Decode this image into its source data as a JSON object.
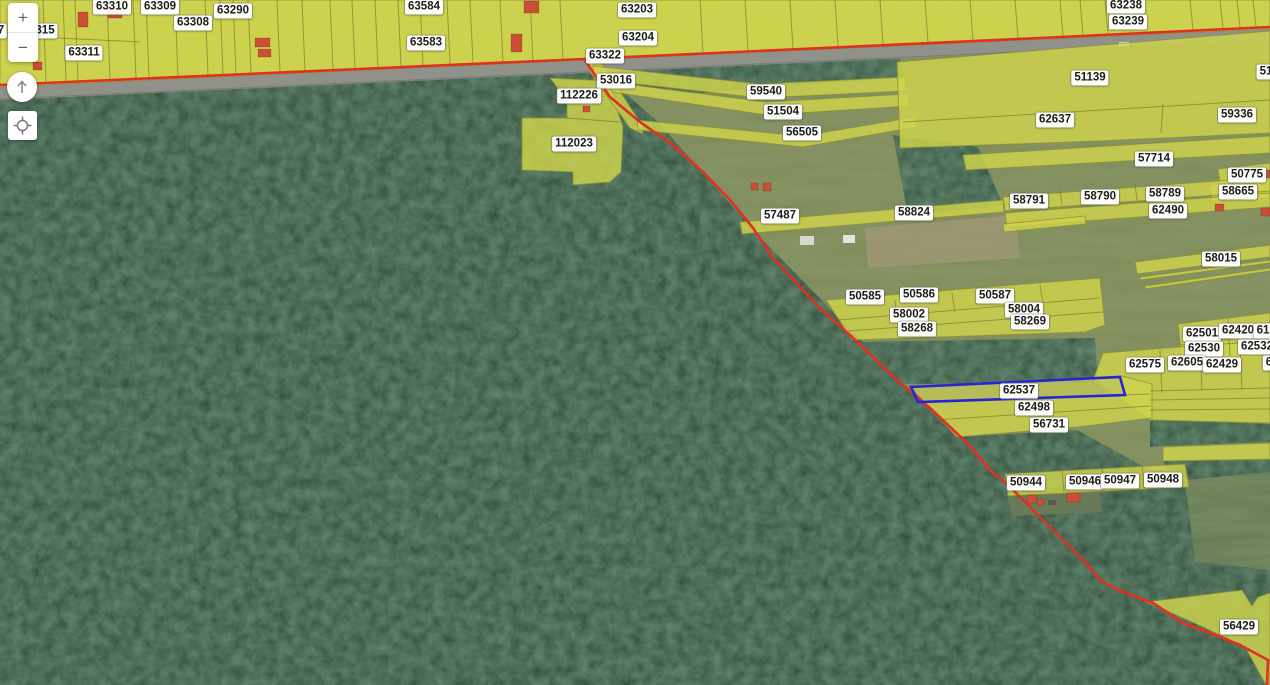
{
  "app": {
    "description": "cadastral parcel map viewer over aerial imagery"
  },
  "controls": {
    "zoom_in": "+",
    "zoom_out": "−"
  },
  "map": {
    "selected_parcel_id": "62537",
    "colors": {
      "parcel_highlight": "#d0d44c",
      "boundary_line": "#e03022",
      "selection_outline": "#2525d6",
      "label_background": "#ffffff",
      "road": "#90918b"
    },
    "labels": [
      {
        "id": "7",
        "x": 1,
        "y": 31
      },
      {
        "id": "315",
        "x": 45,
        "y": 31
      },
      {
        "id": "63311",
        "x": 84,
        "y": 53
      },
      {
        "id": "63310",
        "x": 112,
        "y": 7
      },
      {
        "id": "63309",
        "x": 160,
        "y": 7
      },
      {
        "id": "63308",
        "x": 193,
        "y": 23
      },
      {
        "id": "63290",
        "x": 233,
        "y": 11
      },
      {
        "id": "63584",
        "x": 424,
        "y": 7
      },
      {
        "id": "63583",
        "x": 426,
        "y": 43
      },
      {
        "id": "63203",
        "x": 637,
        "y": 10
      },
      {
        "id": "63204",
        "x": 638,
        "y": 38
      },
      {
        "id": "63322",
        "x": 605,
        "y": 56
      },
      {
        "id": "63238",
        "x": 1126,
        "y": 6
      },
      {
        "id": "63239",
        "x": 1128,
        "y": 22
      },
      {
        "id": "53016",
        "x": 616,
        "y": 81
      },
      {
        "id": "112226",
        "x": 579,
        "y": 96
      },
      {
        "id": "112023",
        "x": 574,
        "y": 144
      },
      {
        "id": "59540",
        "x": 766,
        "y": 92
      },
      {
        "id": "51504",
        "x": 783,
        "y": 112
      },
      {
        "id": "56505",
        "x": 802,
        "y": 133
      },
      {
        "id": "51139",
        "x": 1090,
        "y": 78
      },
      {
        "id": "62637",
        "x": 1055,
        "y": 120
      },
      {
        "id": "59336",
        "x": 1237,
        "y": 115
      },
      {
        "id": "51",
        "x": 1266,
        "y": 72
      },
      {
        "id": "57714",
        "x": 1154,
        "y": 159
      },
      {
        "id": "50775",
        "x": 1247,
        "y": 175
      },
      {
        "id": "58665",
        "x": 1238,
        "y": 192
      },
      {
        "id": "58791",
        "x": 1029,
        "y": 201
      },
      {
        "id": "58790",
        "x": 1100,
        "y": 197
      },
      {
        "id": "58789",
        "x": 1165,
        "y": 194
      },
      {
        "id": "62490",
        "x": 1168,
        "y": 211
      },
      {
        "id": "57487",
        "x": 780,
        "y": 216
      },
      {
        "id": "58824",
        "x": 914,
        "y": 213
      },
      {
        "id": "58015",
        "x": 1221,
        "y": 259
      },
      {
        "id": "50585",
        "x": 865,
        "y": 297
      },
      {
        "id": "50586",
        "x": 919,
        "y": 295
      },
      {
        "id": "50587",
        "x": 995,
        "y": 296
      },
      {
        "id": "58002",
        "x": 909,
        "y": 315
      },
      {
        "id": "58004",
        "x": 1024,
        "y": 310
      },
      {
        "id": "58268",
        "x": 917,
        "y": 329
      },
      {
        "id": "58269",
        "x": 1030,
        "y": 322
      },
      {
        "id": "62501",
        "x": 1202,
        "y": 334
      },
      {
        "id": "62420",
        "x": 1238,
        "y": 331
      },
      {
        "id": "61",
        "x": 1263,
        "y": 331
      },
      {
        "id": "62530",
        "x": 1204,
        "y": 349
      },
      {
        "id": "62532",
        "x": 1257,
        "y": 347
      },
      {
        "id": "62575",
        "x": 1145,
        "y": 365
      },
      {
        "id": "62605",
        "x": 1187,
        "y": 363
      },
      {
        "id": "62429",
        "x": 1222,
        "y": 365
      },
      {
        "id": "6",
        "x": 1269,
        "y": 363
      },
      {
        "id": "62537",
        "x": 1019,
        "y": 391
      },
      {
        "id": "62498",
        "x": 1034,
        "y": 408
      },
      {
        "id": "56731",
        "x": 1049,
        "y": 425
      },
      {
        "id": "50944",
        "x": 1026,
        "y": 483
      },
      {
        "id": "50946",
        "x": 1085,
        "y": 482
      },
      {
        "id": "50947",
        "x": 1120,
        "y": 481
      },
      {
        "id": "50948",
        "x": 1163,
        "y": 480
      },
      {
        "id": "56429",
        "x": 1239,
        "y": 627
      }
    ]
  }
}
